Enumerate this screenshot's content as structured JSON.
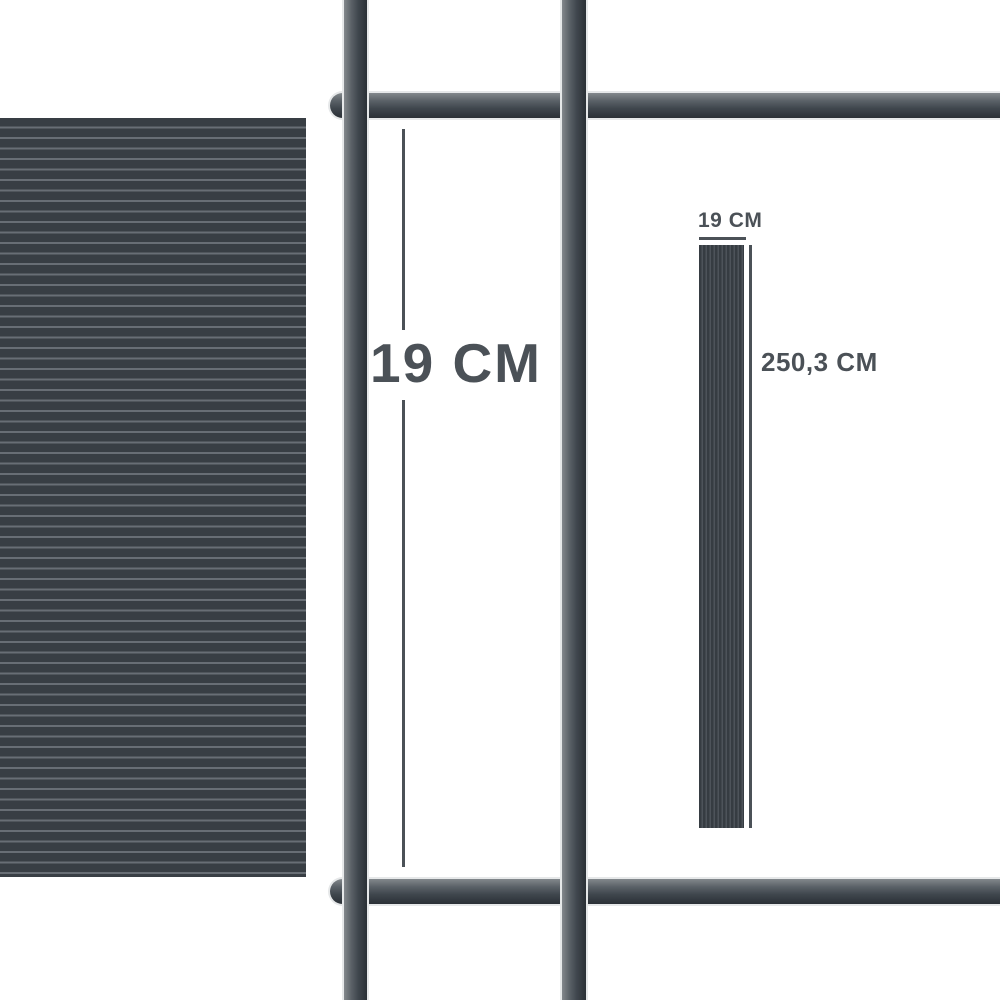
{
  "illustration": {
    "description": "fence privacy strip dimension diagram",
    "gap_dimension": {
      "label": "19 CM"
    },
    "strip_sample": {
      "width_label": "19 CM",
      "length_label": "250,3 CM"
    },
    "colors": {
      "background": "#ffffff",
      "text": "#4b5157",
      "dimension_line": "#4b5157",
      "panel_base": "#383e44",
      "panel_stripe": "#686e75",
      "bar_gradient_light": "#83888c",
      "bar_gradient_mid": "#4e555c",
      "bar_gradient_dark": "#2b3036",
      "bar_halo": "#e6e8e9",
      "strip_base": "#363c42",
      "strip_pinstripe": "#4d535a"
    }
  }
}
